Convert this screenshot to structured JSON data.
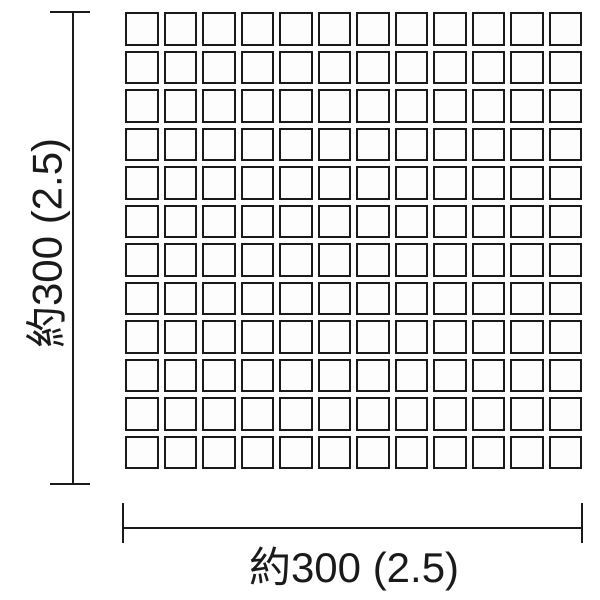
{
  "canvas": {
    "background": "#ffffff"
  },
  "diagram": {
    "grid": {
      "rows": 12,
      "cols": 12,
      "tile_count": 144,
      "tile_fill": "#fdfdfd",
      "tile_border_color": "#1a1a1a"
    },
    "dimension_lines": {
      "color": "#1a1a1a"
    },
    "labels": {
      "height": "約300 (2.5)",
      "width": "約300 (2.5)"
    }
  }
}
